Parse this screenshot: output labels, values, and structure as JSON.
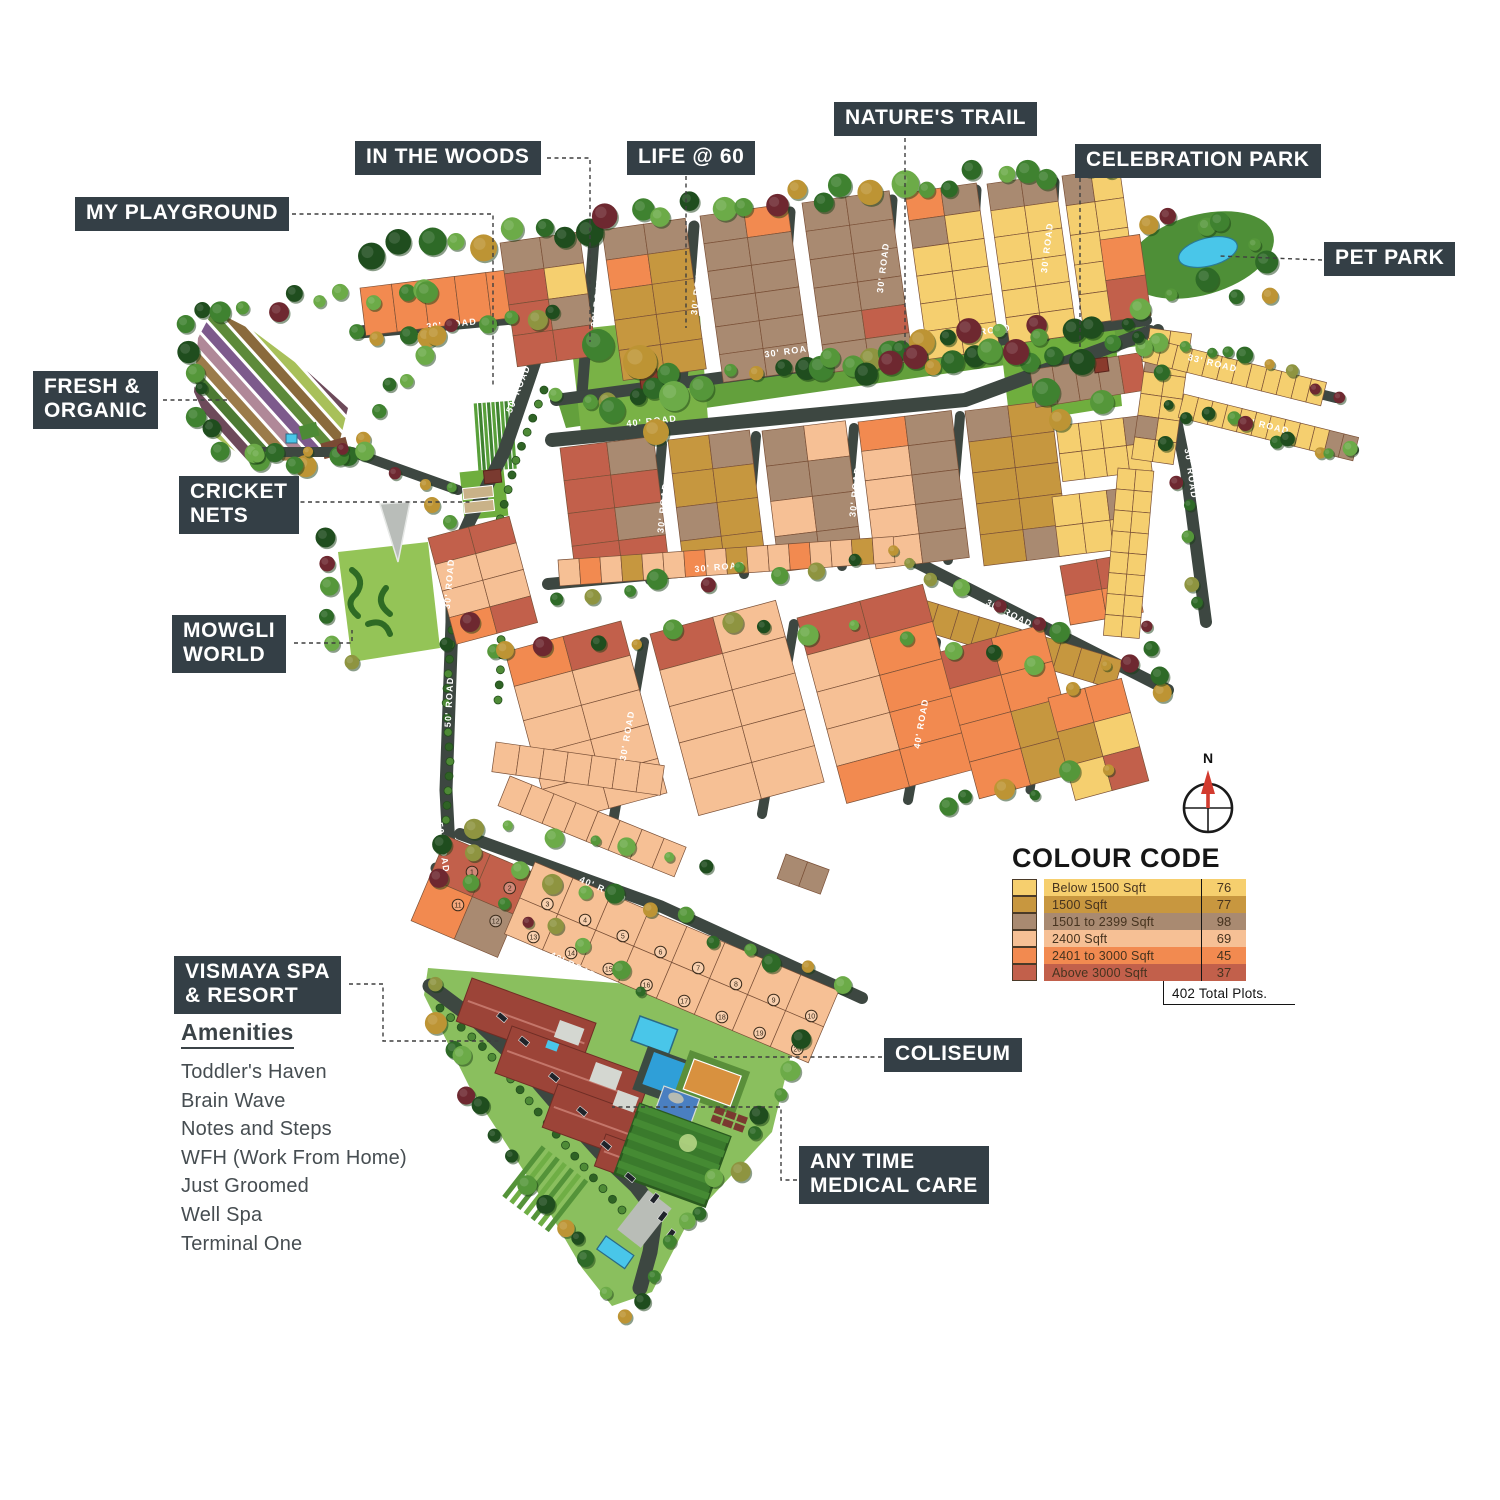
{
  "labels": {
    "my_playground": "MY PLAYGROUND",
    "in_the_woods": "IN THE WOODS",
    "life_at_60": "LIFE @ 60",
    "natures_trail": "NATURE'S TRAIL",
    "celebration_park": "CELEBRATION PARK",
    "pet_park": "PET PARK",
    "fresh_organic": "FRESH &\nORGANIC",
    "cricket_nets": "CRICKET\nNETS",
    "mowgli_world": "MOWGLI\nWORLD",
    "vismaya_spa": "VISMAYA SPA\n& RESORT",
    "coliseum": "COLISEUM",
    "any_time_medical": "ANY TIME\nMEDICAL CARE"
  },
  "amenities": {
    "heading": "Amenities",
    "items": [
      "Toddler's Haven",
      "Brain Wave",
      "Notes and Steps",
      "WFH (Work From Home)",
      "Just Groomed",
      "Well Spa",
      "Terminal One"
    ]
  },
  "legend": {
    "title": "COLOUR CODE",
    "rows": [
      {
        "label": "Below 1500 Sqft",
        "count": "76",
        "color": "#F6CF6E"
      },
      {
        "label": "1500 Sqft",
        "count": "77",
        "color": "#C8973F"
      },
      {
        "label": "1501 to 2399 Sqft",
        "count": "98",
        "color": "#A98A71"
      },
      {
        "label": "2400 Sqft",
        "count": "69",
        "color": "#F6C095"
      },
      {
        "label": "2401 to 3000 Sqft",
        "count": "45",
        "color": "#F28A50"
      },
      {
        "label": "Above 3000 Sqft",
        "count": "37",
        "color": "#C2604B"
      }
    ],
    "total": "402 Total Plots."
  },
  "compass": {
    "north_label": "N"
  },
  "roads": {
    "r30": "30' ROAD",
    "r33": "33' ROAD",
    "r40": "40' ROAD",
    "r50": "50' ROAD"
  },
  "map": {
    "circled_plots": {
      "start": 1,
      "end": 20
    },
    "colors": {
      "road": "#3d4741",
      "tree_green": "#2e6a27",
      "tree_maroon": "#6e2830",
      "tree_gold": "#bd9434",
      "lawn": "#6fae3e",
      "water": "#49c6e9",
      "roof": "#9c4438",
      "label_box": "#343F46"
    }
  }
}
